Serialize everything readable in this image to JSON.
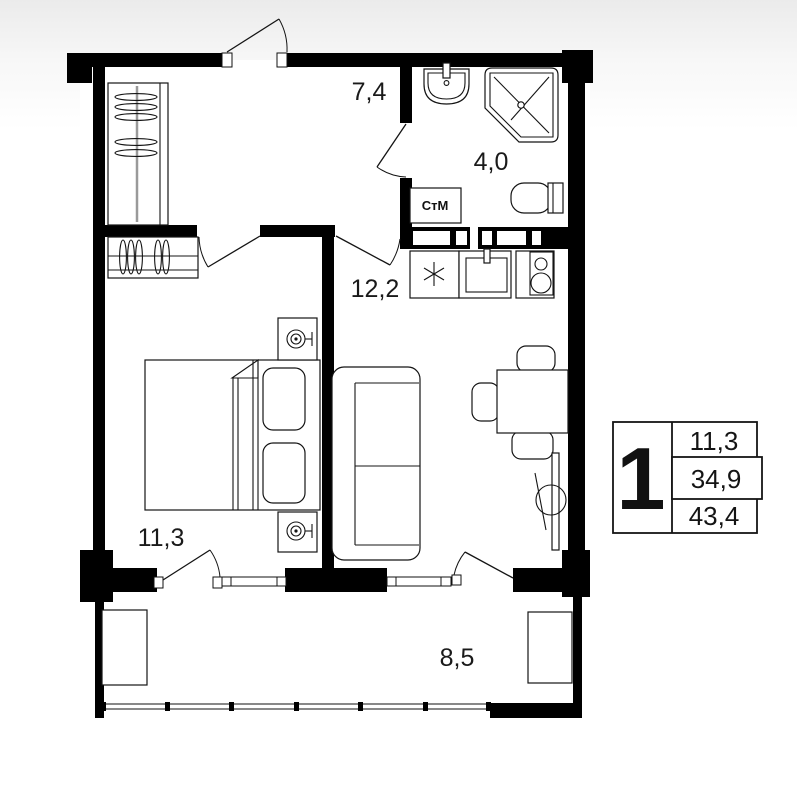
{
  "rooms": {
    "hallway": {
      "area": "7,4"
    },
    "bathroom": {
      "area": "4,0"
    },
    "kitchen_living": {
      "area": "12,2"
    },
    "bedroom": {
      "area": "11,3"
    },
    "balcony": {
      "area": "8,5"
    }
  },
  "appliance_labels": {
    "washing_machine": "СтМ"
  },
  "legend": {
    "room_count": "1",
    "rows": [
      "11,3",
      "34,9",
      "43,4"
    ]
  },
  "colors": {
    "wall": "#000000",
    "line": "#141414",
    "label": "#1a1a1a",
    "background": "#ffffff"
  }
}
